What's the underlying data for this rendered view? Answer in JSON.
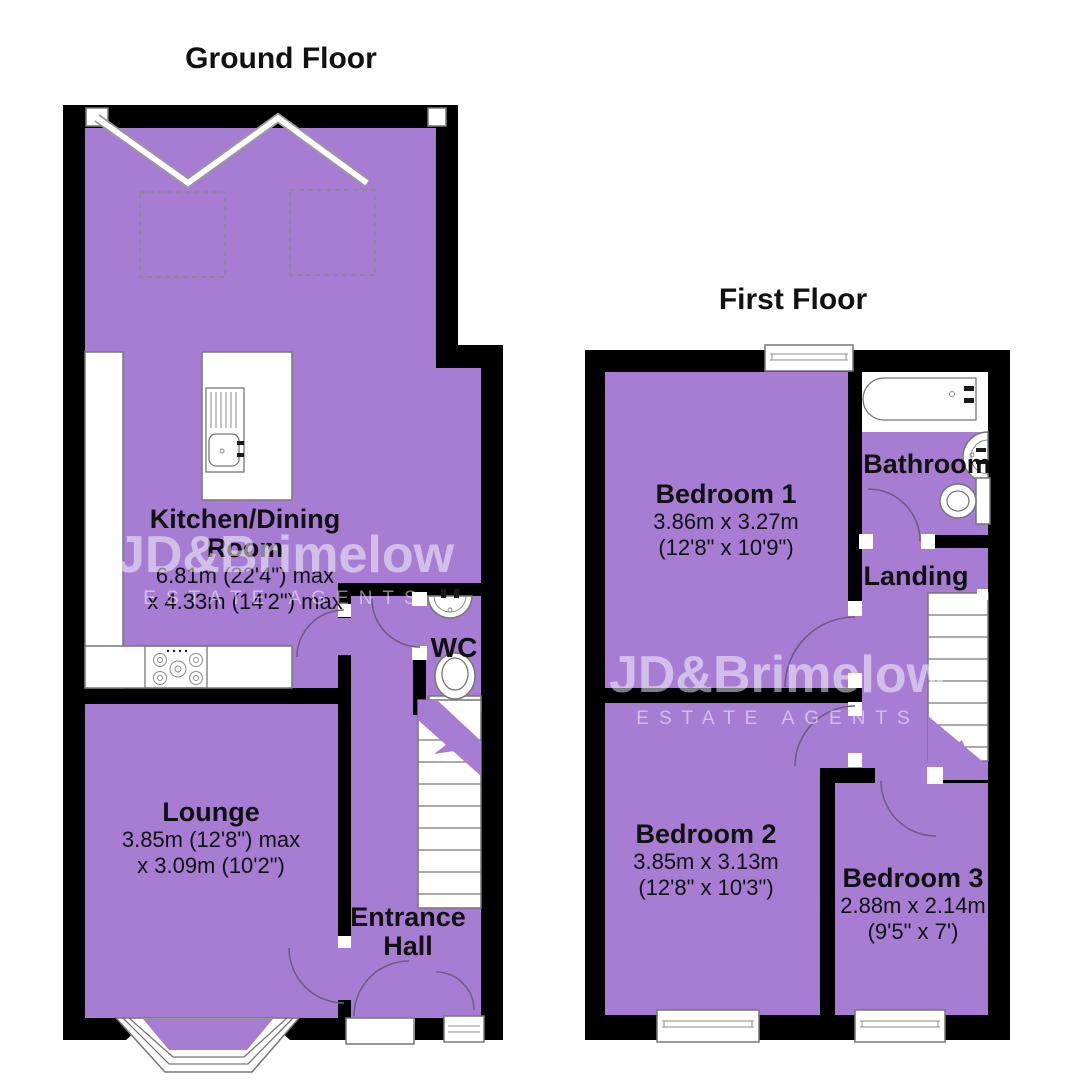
{
  "colors": {
    "floor_fill": "#a77dd3",
    "wall": "#000000",
    "fixture_stroke": "#777777",
    "label": "#111111",
    "watermark": "rgba(255,255,255,0.5)"
  },
  "watermark": {
    "brand": "JD&Brimelow",
    "tagline": "ESTATE AGENTS"
  },
  "floors": {
    "ground": {
      "title": "Ground Floor",
      "rooms": {
        "kitchen": {
          "name": "Kitchen/Dining Room",
          "dims": [
            "6.81m (22'4\") max",
            "x 4.33m (14'2\") max"
          ]
        },
        "lounge": {
          "name": "Lounge",
          "dims": [
            "3.85m (12'8\") max",
            "x 3.09m (10'2\")"
          ]
        },
        "wc": {
          "name": "WC"
        },
        "entrance_hall": {
          "name": "Entrance Hall"
        }
      }
    },
    "first": {
      "title": "First Floor",
      "rooms": {
        "bedroom1": {
          "name": "Bedroom 1",
          "dims": [
            "3.86m x 3.27m",
            "(12'8\" x 10'9\")"
          ]
        },
        "bathroom": {
          "name": "Bathroom"
        },
        "landing": {
          "name": "Landing"
        },
        "bedroom2": {
          "name": "Bedroom 2",
          "dims": [
            "3.85m x 3.13m",
            "(12'8\" x 10'3\")"
          ]
        },
        "bedroom3": {
          "name": "Bedroom 3",
          "dims": [
            "2.88m x 2.14m",
            "(9'5\" x 7')"
          ]
        }
      }
    }
  }
}
